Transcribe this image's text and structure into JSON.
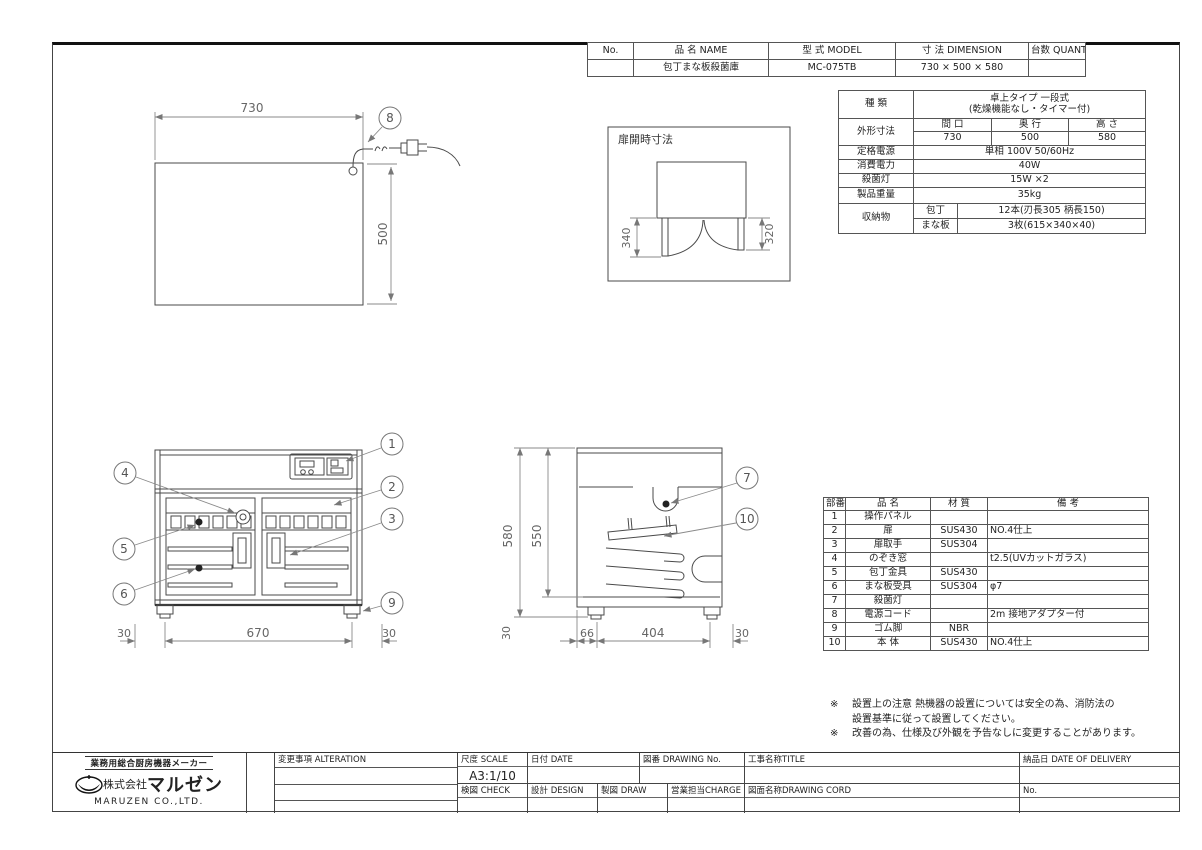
{
  "header_table": {
    "cols": [
      "No.",
      "品 名 NAME",
      "型 式 MODEL",
      "寸 法 DIMENSION",
      "台数 QUANTITY"
    ],
    "row": {
      "no": "",
      "name": "包丁まな板殺菌庫",
      "model": "MC-075TB",
      "dimension": "730 × 500 × 580",
      "quantity": ""
    }
  },
  "spec_table": {
    "kind_label": "種 類",
    "kind_line1": "卓上タイプ 一段式",
    "kind_line2": "(乾燥機能なし・タイマー付)",
    "dims_label": "外形寸法",
    "dims_h1": "間 口",
    "dims_h2": "奥 行",
    "dims_h3": "高 さ",
    "dims_v1": "730",
    "dims_v2": "500",
    "dims_v3": "580",
    "power_label": "定格電源",
    "power_value": "単相 100V 50/60Hz",
    "consumption_label": "消費電力",
    "consumption_value": "40W",
    "lamp_label": "殺菌灯",
    "lamp_value": "15W ×2",
    "weight_label": "製品重量",
    "weight_value": "35kg",
    "storage_label": "収納物",
    "storage_knife_label": "包丁",
    "storage_knife_value": "12本(刃長305 柄長150)",
    "storage_board_label": "まな板",
    "storage_board_value": "3枚(615×340×40)"
  },
  "parts_table": {
    "headers": [
      "部番",
      "品 名",
      "材 質",
      "備 考"
    ],
    "rows": [
      {
        "no": "1",
        "name": "操作パネル",
        "material": "",
        "note": ""
      },
      {
        "no": "2",
        "name": "扉",
        "material": "SUS430",
        "note": "NO.4仕上"
      },
      {
        "no": "3",
        "name": "扉取手",
        "material": "SUS304",
        "note": ""
      },
      {
        "no": "4",
        "name": "のぞき窓",
        "material": "",
        "note": "t2.5(UVカットガラス)"
      },
      {
        "no": "5",
        "name": "包丁金具",
        "material": "SUS430",
        "note": ""
      },
      {
        "no": "6",
        "name": "まな板受具",
        "material": "SUS304",
        "note": "φ7"
      },
      {
        "no": "7",
        "name": "殺菌灯",
        "material": "",
        "note": ""
      },
      {
        "no": "8",
        "name": "電源コード",
        "material": "",
        "note": "2m 接地アダプター付"
      },
      {
        "no": "9",
        "name": "ゴム脚",
        "material": "NBR",
        "note": ""
      },
      {
        "no": "10",
        "name": "本 体",
        "material": "SUS430",
        "note": "NO.4仕上"
      }
    ]
  },
  "notes": {
    "note1_mark": "※",
    "note1_line1": "設置上の注意 熱機器の設置については安全の為、消防法の",
    "note1_line2": "設置基準に従って設置してください。",
    "note2_mark": "※",
    "note2_line1": "改善の為、仕様及び外観を予告なしに変更することがあります。"
  },
  "drawing": {
    "door_open_label": "扉開時寸法",
    "callouts": [
      "1",
      "2",
      "3",
      "4",
      "5",
      "6",
      "7",
      "8",
      "9",
      "10"
    ],
    "dims": {
      "top_width": "730",
      "top_depth": "500",
      "door_left": "340",
      "door_right": "320",
      "front_left": "30",
      "front_center": "670",
      "front_right": "30",
      "side_total": "580",
      "side_body": "550",
      "side_foot": "30",
      "side_front": "66",
      "side_center": "404",
      "side_back": "30"
    }
  },
  "title_block": {
    "maker_tagline": "業務用総合厨房機器メーカー",
    "company_prefix": "株式会社",
    "company_name": "マルゼン",
    "company_en": "MARUZEN CO.,LTD.",
    "alteration": "変更事項 ALTERATION",
    "scale": "尺度 SCALE",
    "scale_value": "A3:1/10",
    "date": "日付 DATE",
    "drawing_no": "図番 DRAWING No.",
    "title": "工事名称TITLE",
    "check": "検図 CHECK",
    "design": "設計 DESIGN",
    "draw": "製図 DRAW",
    "charge": "営業担当CHARGE",
    "drawing_cord": "図面名称DRAWING CORD",
    "delivery": "納品日 DATE OF DELIVERY",
    "no": "No."
  }
}
